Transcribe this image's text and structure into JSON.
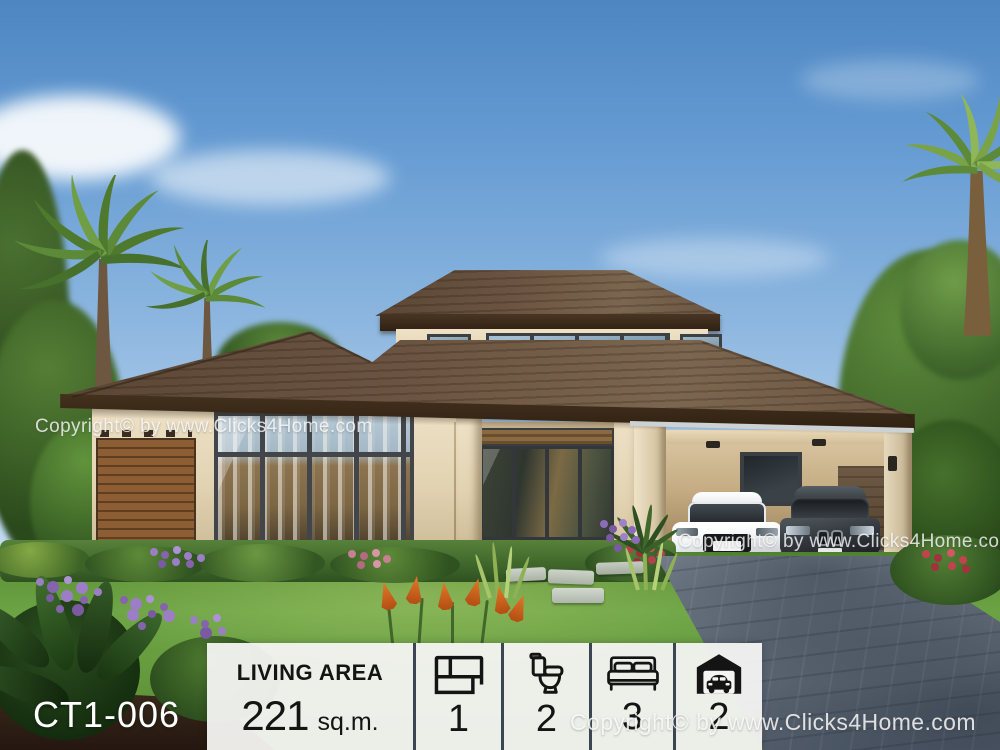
{
  "plan_code": "CT1-006",
  "watermark": {
    "text": "Copyright© by www.Clicks4Home.com"
  },
  "panel": {
    "living_area": {
      "label": "LIVING AREA",
      "value": "221",
      "unit": "sq.m."
    },
    "stats": [
      {
        "name": "floor-plan",
        "icon": "floor-plan-icon",
        "value": "1"
      },
      {
        "name": "bathrooms",
        "icon": "toilet-icon",
        "value": "2"
      },
      {
        "name": "bedrooms",
        "icon": "bed-icon",
        "value": "3"
      },
      {
        "name": "car-garage",
        "icon": "garage-icon",
        "value": "2"
      }
    ],
    "background": "#f4f4f2",
    "divider_color": "#3c4653",
    "text_color": "#141414"
  },
  "colors": {
    "sky_top": "#4d86c2",
    "sky_horizon": "#dcebf7",
    "roof": "#6a5441",
    "fascia": "#38281a",
    "wall_cream": "#e9dcc1",
    "wood_slats": "#8a5c33",
    "lawn": "#66a040",
    "hedge": "#3f6b2a",
    "driveway": "#7c8793",
    "watermark_text": "rgba(255,255,255,0.78)"
  }
}
